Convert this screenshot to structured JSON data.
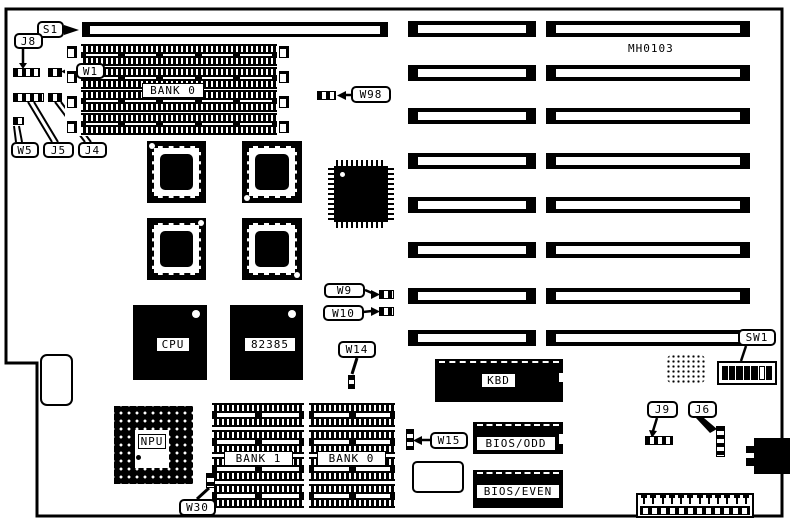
{
  "board": {
    "part_number": "MH0103"
  },
  "callouts": {
    "s1": "S1",
    "j8": "J8",
    "w1": "W1",
    "w5": "W5",
    "j5": "J5",
    "j4": "J4",
    "w98": "W98",
    "w9": "W9",
    "w10": "W10",
    "w14": "W14",
    "w15": "W15",
    "w30": "W30",
    "j9": "J9",
    "j6": "J6",
    "sw1": "SW1"
  },
  "chips": {
    "cpu": "CPU",
    "cache": "82385",
    "kbd": "KBD",
    "npu": "NPU",
    "bios_odd": "BIOS/ODD",
    "bios_even": "BIOS/EVEN"
  },
  "memory": {
    "bank0_top": "BANK 0",
    "bank1": "BANK 1",
    "bank0_bottom": "BANK 0"
  },
  "colors": {
    "ink": "#000000",
    "paper": "#ffffff"
  }
}
